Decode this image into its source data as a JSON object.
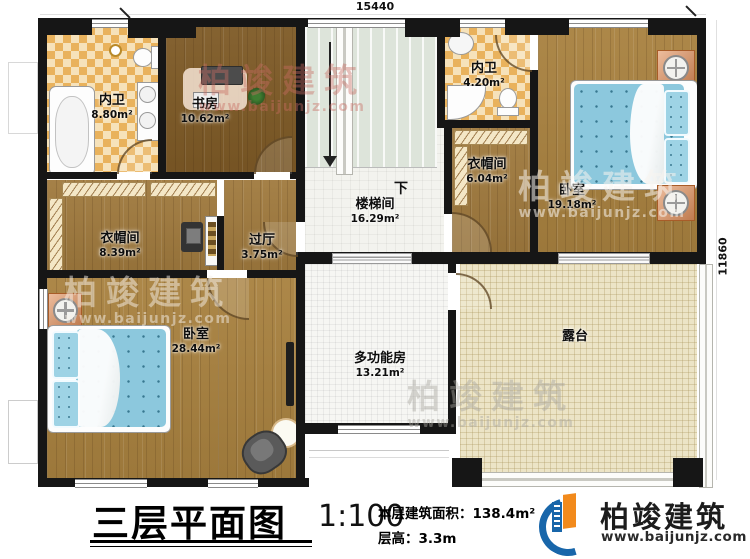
{
  "plan": {
    "dimension_top": "15440",
    "dimension_right": "11860",
    "stair_direction": "下",
    "watermark": {
      "brand": "柏竣建筑",
      "url": "www.baijunjz.com"
    },
    "rooms": [
      {
        "name": "内卫",
        "area": "8.80m²"
      },
      {
        "name": "书房",
        "area": "10.62m²"
      },
      {
        "name": "内卫",
        "area": "4.20m²"
      },
      {
        "name": "卧室",
        "area": "19.18m²"
      },
      {
        "name": "衣帽间",
        "area": "6.04m²"
      },
      {
        "name": "衣帽间",
        "area": "8.39m²"
      },
      {
        "name": "过厅",
        "area": "3.75m²"
      },
      {
        "name": "楼梯间",
        "area": "16.29m²"
      },
      {
        "name": "卧室",
        "area": "28.44m²"
      },
      {
        "name": "多功能房",
        "area": "13.21m²"
      },
      {
        "name": "露台",
        "area": ""
      }
    ]
  },
  "titleblock": {
    "title": "三层平面图",
    "scale": "1:100",
    "area_text": "本层建筑面积：138.4m²",
    "height_text": "层高：3.3m"
  },
  "logo": {
    "brand": "柏竣建筑",
    "url": "www.baijunjz.com"
  },
  "colors": {
    "accent_blue": "#1866aa",
    "accent_orange": "#f28a1c",
    "wall": "#161616"
  }
}
